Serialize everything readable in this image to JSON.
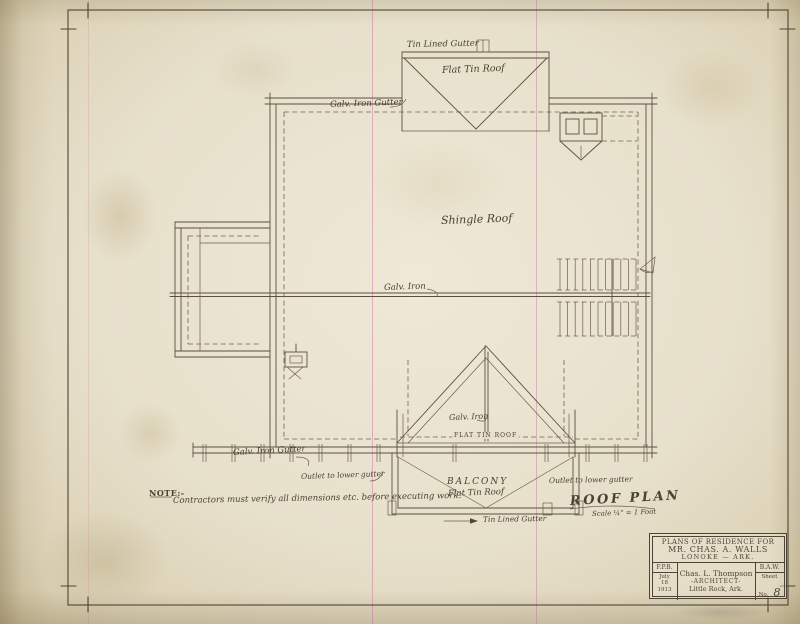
{
  "sheet": {
    "drawing_title": "ROOF PLAN",
    "drawing_scale": "Scale ¼\" = 1 Foot",
    "note_label": "NOTE:-",
    "note_text": "Contractors must verify all dimensions etc. before executing work."
  },
  "annotations": {
    "tin_lined_gutter_top": "Tin Lined Gutter",
    "flat_tin_roof_top": "Flat Tin Roof",
    "galv_iron_gutter_top": "Galv. Iron Gutter",
    "shingle_roof": "Shingle Roof",
    "galv_iron_ridge": "Galv. Iron",
    "galv_iron_gable_ridge": "Galv. Iron",
    "flat_tin_roof_balcony_wall": "FLAT TIN ROOF",
    "galv_iron_gutter_bottom": "Galv. Iron Gutter",
    "outlet_to_lower_gutter_left": "Outlet to lower gutter",
    "outlet_to_lower_gutter_right": "Outlet to lower gutter",
    "balcony": "BALCONY",
    "balcony_flat_tin_roof": "Flat Tin Roof",
    "tin_lined_gutter_bottom": "Tin Lined Gutter"
  },
  "title_block": {
    "project_line1": "PLANS OF RESIDENCE FOR",
    "project_line2": "MR. CHAS. A. WALLS",
    "project_line3": "LONOKE — ARK.",
    "drawn_by": "F.P.B.",
    "date_month": "July",
    "date_day": "18",
    "date_year": "1913",
    "architect_name": "Chas. L. Thompson",
    "architect_title": "-ARCHITECT-",
    "architect_city": "Little Rock, Ark.",
    "traced_by": "B.A.W.",
    "sheet_word": "Sheet",
    "sheet_no_word": "No.",
    "sheet_number": "8"
  },
  "colors": {
    "paper": "#e7e0cb",
    "ink": "#4f4537",
    "ink_light": "#6b5f4d",
    "fold_line_pink": "#c75da0"
  }
}
